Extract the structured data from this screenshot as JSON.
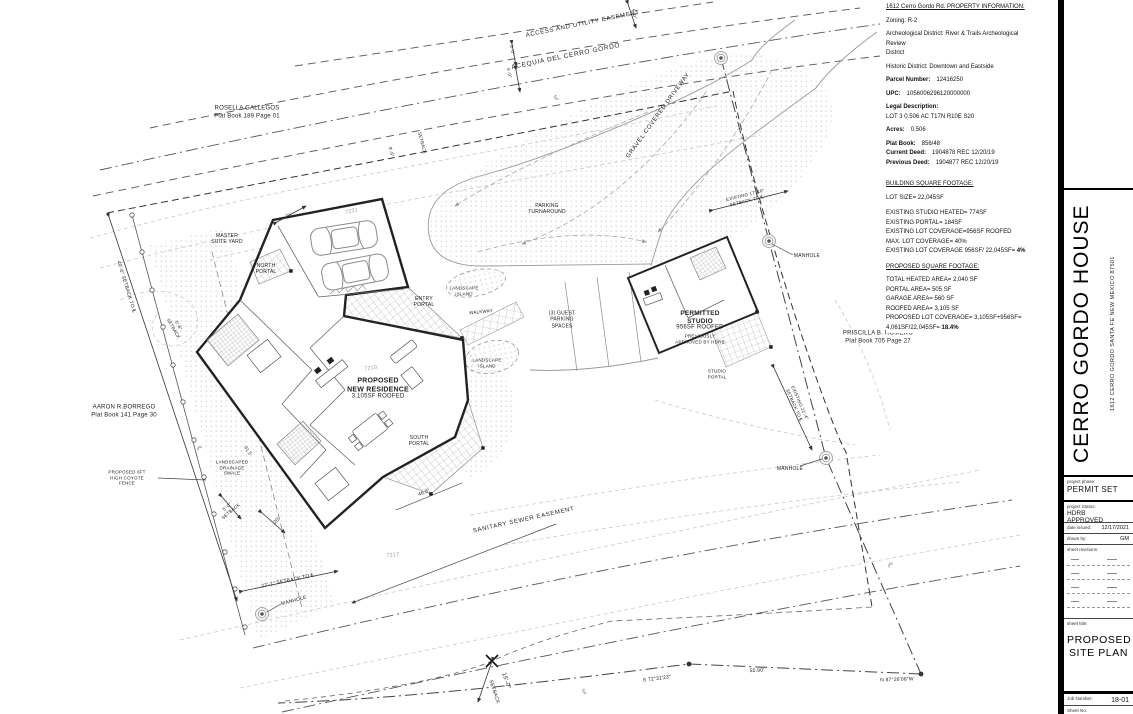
{
  "info": {
    "title": "1612 Cerro Gordo Rd. PROPERTY INFORMATION:",
    "zoning": "Zoning: R-2",
    "arch_district": "Archeological District: River & Trails Archeological Review\nDistrict",
    "historic_district": "Historic District: Downtown and Eastside",
    "parcel_label": "Parcel Number:",
    "parcel_value": "12416250",
    "upc_label": "UPC:",
    "upc_value": "1056006296120000000",
    "legal_label": "Legal Description:",
    "legal_value": "LOT 3 0.506 AC T17N R10E S20",
    "acres_label": "Acres:",
    "acres_value": "0.506",
    "plat_label": "Plat Book:",
    "plat_value": "856/48",
    "current_deed_label": "Current Deed:",
    "current_deed_value": "1904878 REC 12/20/19",
    "previous_deed_label": "Previous Deed:",
    "previous_deed_value": "1904877 REC 12/20/19",
    "building_title": "BUILDING SQUARE FOOTAGE:",
    "lot_size": "LOT SIZE= 22,045SF",
    "b1": "EXISTING STUDIO HEATED= 774SF",
    "b2": "EXISTING PORTAL= 184SF",
    "b3": "EXISTING LOT COVERAGE=956SF ROOFED",
    "b4": "MAX. LOT COVERAGE= 40%",
    "b5a": "EXISTING LOT COVERAGE 956SF/ 22,045SF= ",
    "b5b": "4%",
    "proposed_title": "PROPOSED SQUARE FOOTAGE:",
    "p1": "TOTAL HEATED AREA= 2,040 SF",
    "p2": "PORTAL AREA= 505 SF",
    "p3": "GARAGE AREA= 560 SF",
    "p4": "ROOFED AREA= 3,105 SF",
    "p5": "PROPOSED LOT COVERAGE= 3,105SF+956SF=",
    "p6a": "4,061SF/22,045SF= ",
    "p6b": "18.4%"
  },
  "titleblock": {
    "project_title": "CERRO GORDO HOUSE",
    "project_address": "1612 CERRO GORDO   SANTA FE NEW MEXICO 87501",
    "phase_label": "project phase:",
    "phase_value": "PERMIT SET",
    "status_label": "project Status:",
    "status_value": "HDRB\nAPPROVED",
    "date_label": "date issued:",
    "date_value": "12/17/2021",
    "drawn_label": "drawn by:",
    "drawn_value": "GM",
    "revisions_label": "sheet revisions:",
    "sheet_title_label": "sheet title:",
    "sheet_title_value": "PROPOSED\nSITE PLAN",
    "job_label": "Job Number:",
    "job_value": "18-01",
    "sheet_no_label": "Sheet No."
  },
  "plan": {
    "labels": {
      "rosella": "ROSELLA GALLEGOS\nPlat Book 189 Page 01",
      "access_easement": "ACCESS AND UTILITY EASEMENT",
      "acequia": "ACEQUIA DEL CERRO GORDO",
      "gravel": "GRAVEL COVERED DRIVEWAY",
      "parking_turnaround": "PARKING\nTURNAROUND",
      "master_yard": "MASTER\nSUITE YARD",
      "north_portal": "NORTH\nPORTAL",
      "entry_portal": "ENTRY\nPORTAL",
      "island1": "LANDSCAPE\nISLAND",
      "walkway": "WALKWAY",
      "guest_parking": "(3) GUEST\nPARKING\nSPACES",
      "island2": "LANDSCAPE\nISLAND",
      "residence_name": "PROPOSED\nNEW RESIDENCE",
      "residence_sf": "3,105SF ROOFED",
      "south_portal": "SOUTH\nPORTAL",
      "studio_name": "PERMITTED\nSTUDIO",
      "studio_sf": "956SF ROOFED",
      "studio_note": "PREVIOUSLY\nAPPROVED BY HDRB",
      "studio_portal": "STUDIO\nPORTAL",
      "priscilla": "PRISCILLA B. ROMERO\nPlat Book 705 Page 27",
      "aaron": "AARON R.BORREGO\nPlat Book 141 Page 30",
      "coyote": "PROPOSED 6FT\nHIGH COYOTE\nFENCE",
      "swale": "LANDSCAPED\nDRAINAGE\nSWALE",
      "sewer": "SANITARY SEWER EASEMENT",
      "manhole1": "MANHOLE",
      "manhole2": "MANHOLE",
      "manhole3": "MANHOLE",
      "s72": "S 72°31'23\"",
      "d5590": "55.90'",
      "n87": "N 87°26'08\"W",
      "set15_a": "15'-0\"",
      "set15_b": "SETBACK",
      "set40": "40'-6\" SETBACK TO ℄",
      "set22": "22'-1\" SETBACK TO ℄",
      "set1710": "EXISTING 17'-10\"\nSETBACK TO ℄",
      "set214": "EXISTING 21'-4\"\nSETBACK TO ℄",
      "d21": "21'",
      "c7221": "7221",
      "c7219": "7219",
      "c7217": "7217",
      "set50": "5'-0\"\nSETBACK",
      "d20": "20'",
      "d466": "46.6'",
      "d915": "91.5'",
      "set56": "5'-6\"\nSETBACK",
      "a50a": "5'-0\"",
      "a50b": "5'-0\"",
      "a50c": "5'-0\"",
      "setTop": "SETBACK",
      "d86": "8'-6\"",
      "cl1": "℄",
      "cl2": "℄",
      "cl3": "℄",
      "cl4": "℄"
    }
  }
}
